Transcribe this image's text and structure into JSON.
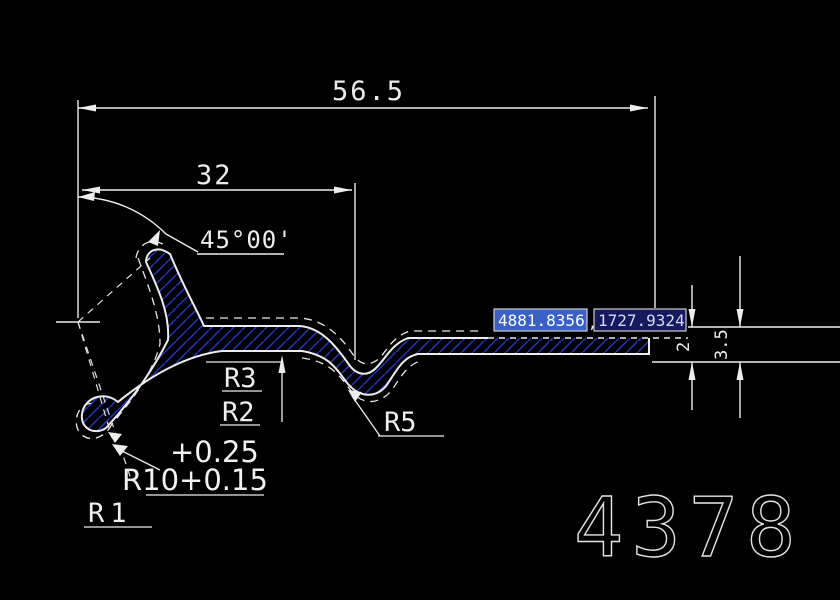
{
  "drawing": {
    "dim_overall": "56.5",
    "dim_left": "32",
    "dim_angle": "45°00'",
    "label_r3": "R3",
    "label_r2": "R2",
    "label_r5": "R5",
    "tol_upper": "+0.25",
    "radius_main": "R10+0.15",
    "label_r1": "R1",
    "dim_thickness": "2",
    "dim_end_height": "3.5",
    "part_number": "4378"
  },
  "dynamic_input": {
    "x_value": "4881.8356",
    "y_value": "1727.9324",
    "separator": ","
  },
  "colors": {
    "background": "#000000",
    "line": "#ededed",
    "hatch_blue": "#2335c4",
    "input_selected_bg": "#3a61c8",
    "input_bg": "#151a5e",
    "input_border": "#cfcfcf",
    "input_text": "#ffffff"
  }
}
